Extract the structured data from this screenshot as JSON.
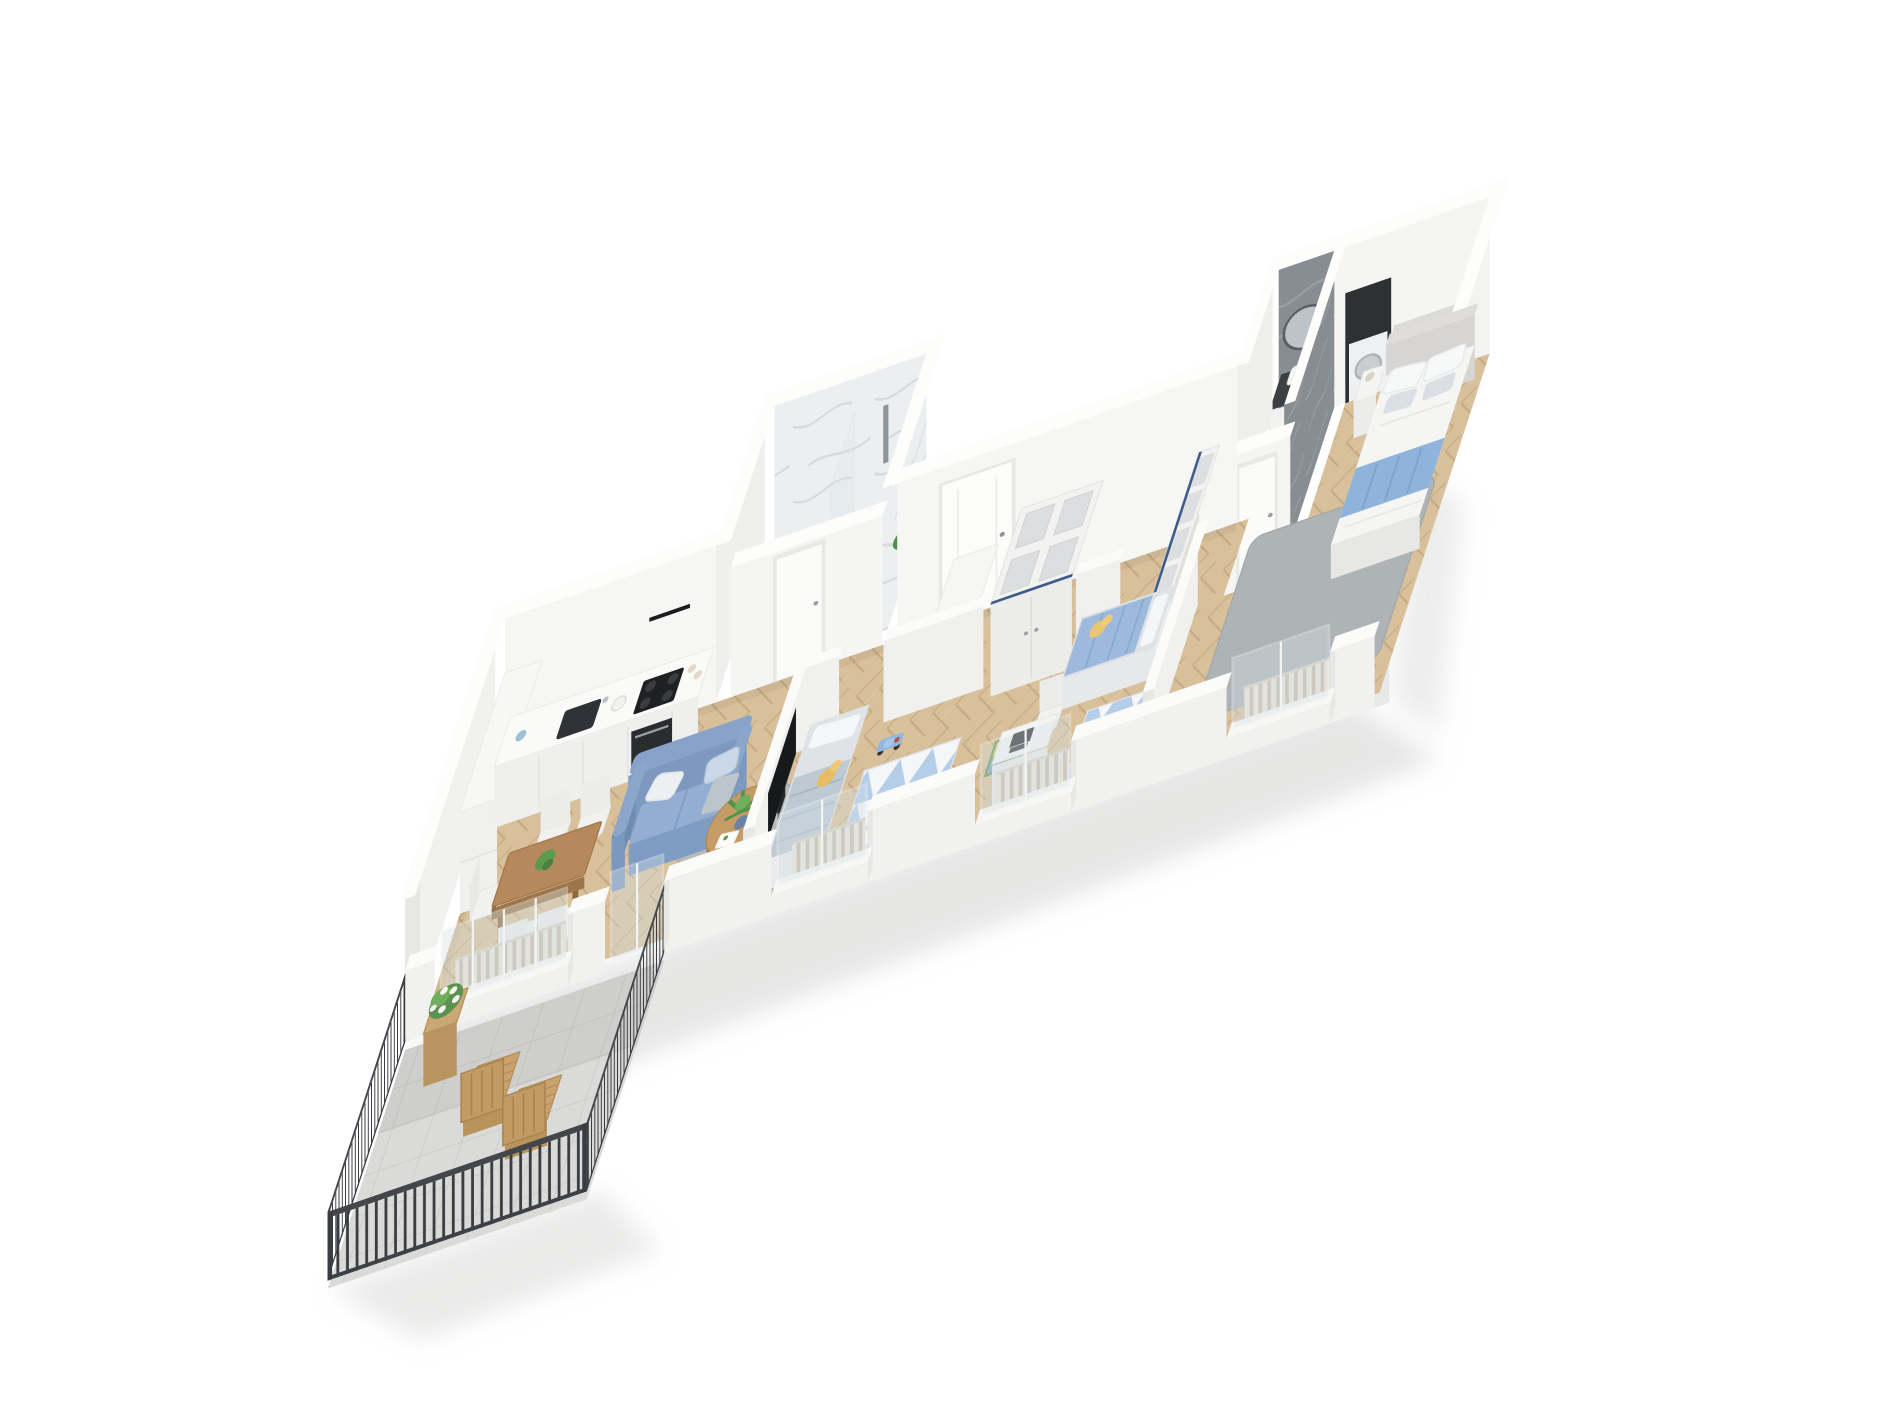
{
  "scene": {
    "title": "3D isometric cutaway floor plan render of a family apartment",
    "background": "#ffffff",
    "projection": "dollhouse axonometric, long strip apartment running lower-left to upper-right"
  },
  "palette": {
    "wall_white": "#f5f5f3",
    "wall_shade": "#e7e7e5",
    "wall_dark": "#dddddb",
    "floor_wood": "#d8c09b",
    "floor_tile": "#dadad8",
    "rug_gray": "#aeb3b6",
    "accent_blue": "#8fb3da",
    "sofa_blue": "#7e9cc4",
    "railing_dark": "#3a3d41",
    "marble_light": "#eceff0",
    "marble_dark": "#878d91",
    "counter_dark": "#3c4043",
    "appliance_dark": "#2c2f33",
    "wood_furniture": "#b5895b",
    "wood_light": "#c9a26d",
    "plant_green": "#5c9150",
    "toy_yellow": "#e9c571",
    "glass": "#d7e0e4"
  },
  "rooms": {
    "living_room": {
      "label": "Open living room with kitchen and dining area",
      "furniture": [
        "white kitchen counter with dark sink, faucet, black cooktop and oven",
        "black range hood strip",
        "tall white cabinet block",
        "wooden dining table with plant",
        "five white chairs",
        "blue two-seat sofa with white and blue cushions",
        "round wooden coffee table with potted plant and paper",
        "round gray rug",
        "herringbone parquet floor"
      ]
    },
    "hallway": {
      "label": "Entrance hallway",
      "furniture": [
        "white entrance door with handle",
        "white dresser",
        "large white cube-storage wardrobe with doors"
      ]
    },
    "shower_bathroom": {
      "label": "Bathroom with walk-in marble shower",
      "furniture": [
        "white marble walls and floor",
        "glass shower screen",
        "chrome shower column",
        "green plant",
        "white door to hallway"
      ]
    },
    "kids_room_1": {
      "label": "Children's room with TV",
      "furniture": [
        "single bed with gray-blue bedding and pillow",
        "yellow plush toy",
        "blue toy car",
        "triangle-pattern rug",
        "black TV on partition wall"
      ]
    },
    "kids_room_2": {
      "label": "Children's room with desk",
      "furniture": [
        "single bed with blue duvet",
        "yellow plush toy",
        "blue robot toy",
        "white desk with dark laptop",
        "white desk chair",
        "green play mat with colored squares",
        "tall open cube shelf"
      ]
    },
    "master_bathroom": {
      "label": "En-suite bathroom in gray marble",
      "furniture": [
        "white vanity with dark counter top",
        "white vessel sink and faucet",
        "round mirror on marble wall",
        "dark niche with white washer"
      ]
    },
    "master_bedroom": {
      "label": "Master bedroom",
      "furniture": [
        "double bed with white linen and blue throw blanket",
        "four pillows",
        "upholstered headboard",
        "white nightstand with lamp",
        "large gray rug"
      ]
    },
    "balcony": {
      "label": "Balcony terrace",
      "furniture": [
        "dark metal bar railing",
        "two wooden slat deck chairs",
        "wooden plant stand with white flowering plant",
        "stone tile floor"
      ]
    }
  },
  "openings": {
    "entrance_door": "white entrance door on back wall",
    "shower_bath_door": "white door to shower bathroom",
    "ensuite_door": "white door to en-suite bathroom",
    "balcony_door": "glass balcony door",
    "windows": [
      "living room window",
      "kids room 1 window",
      "kids room 2 window",
      "master bedroom window"
    ],
    "radiators": 4
  }
}
